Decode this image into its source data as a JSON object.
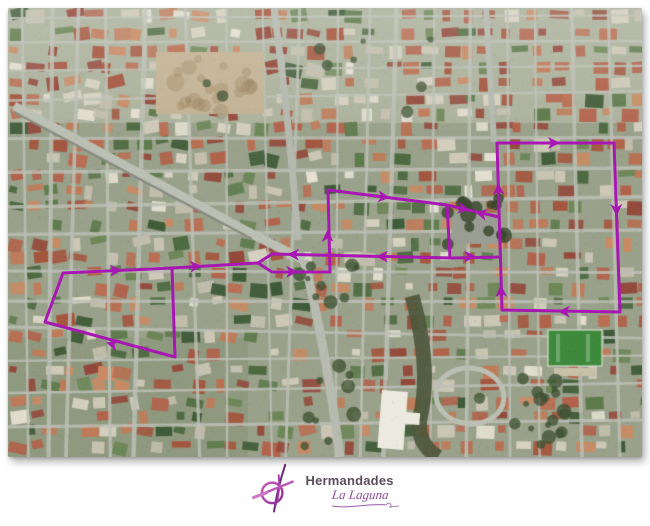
{
  "logo": {
    "title": "Hermandades",
    "subtitle": "La Laguna",
    "title_color": "#5c4c5c",
    "subtitle_color": "#8e4da0",
    "icon": {
      "ring_color": "#b032b4",
      "staff_color": "#6b2f77",
      "bar_color": "#c055ba"
    }
  },
  "map": {
    "route_color": "#a718b2",
    "route_stroke_width": 3,
    "route": {
      "segments": [
        {
          "name": "left-polygon",
          "closed": true,
          "points": [
            [
              63,
              273
            ],
            [
              172,
              268
            ],
            [
              175,
              357
            ],
            [
              45,
              322
            ]
          ]
        },
        {
          "name": "west-connector",
          "closed": false,
          "points": [
            [
              172,
              268
            ],
            [
              258,
              263
            ]
          ]
        },
        {
          "name": "return-street",
          "closed": false,
          "points": [
            [
              258,
              263
            ],
            [
              272,
              254
            ],
            [
              452,
              258
            ],
            [
              500,
              257
            ]
          ]
        },
        {
          "name": "outbound-street",
          "closed": false,
          "points": [
            [
              258,
              263
            ],
            [
              272,
              272
            ],
            [
              330,
              272
            ]
          ]
        },
        {
          "name": "mid-left-edge",
          "closed": false,
          "points": [
            [
              330,
              272
            ],
            [
              328,
              190
            ]
          ]
        },
        {
          "name": "mid-top-edge",
          "closed": false,
          "points": [
            [
              328,
              190
            ],
            [
              447,
              205
            ]
          ]
        },
        {
          "name": "mid-right-edge",
          "closed": false,
          "points": [
            [
              447,
              205
            ],
            [
              450,
              258
            ]
          ]
        },
        {
          "name": "plaza-connector",
          "closed": false,
          "points": [
            [
              447,
              205
            ],
            [
              499,
              217
            ]
          ]
        },
        {
          "name": "east-rectangle",
          "closed": true,
          "points": [
            [
              497,
              143
            ],
            [
              614,
              143
            ],
            [
              620,
              312
            ],
            [
              502,
              310
            ]
          ]
        }
      ],
      "arrows": [
        {
          "x": 116,
          "y": 270.5,
          "angle": -3
        },
        {
          "x": 112,
          "y": 344,
          "angle": 195
        },
        {
          "x": 196,
          "y": 266.5,
          "angle": -3
        },
        {
          "x": 293,
          "y": 254.5,
          "angle": 181
        },
        {
          "x": 292,
          "y": 271.8,
          "angle": 0
        },
        {
          "x": 327.5,
          "y": 236,
          "angle": 269
        },
        {
          "x": 384,
          "y": 197,
          "angle": 7
        },
        {
          "x": 382,
          "y": 256.5,
          "angle": 181
        },
        {
          "x": 464,
          "y": 209,
          "angle": 13
        },
        {
          "x": 481,
          "y": 213.5,
          "angle": 193
        },
        {
          "x": 470,
          "y": 256.5,
          "angle": -1
        },
        {
          "x": 554,
          "y": 143,
          "angle": 0
        },
        {
          "x": 616.5,
          "y": 210,
          "angle": 88
        },
        {
          "x": 564,
          "y": 311.5,
          "angle": 181
        },
        {
          "x": 501,
          "y": 291,
          "angle": 268
        },
        {
          "x": 498.4,
          "y": 189,
          "angle": 268
        }
      ]
    }
  }
}
